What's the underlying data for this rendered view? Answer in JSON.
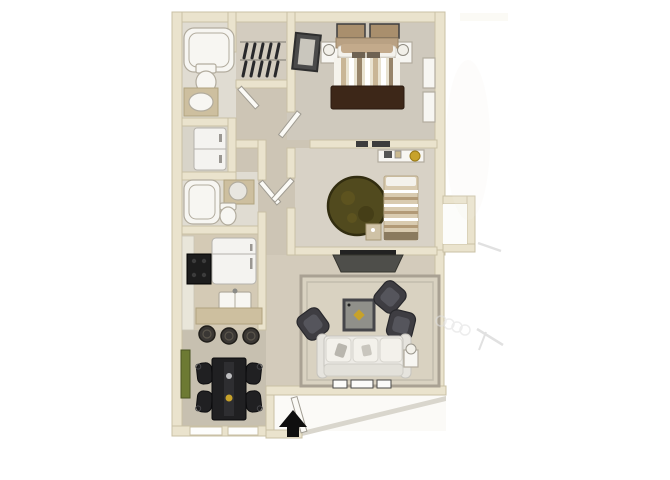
{
  "image": {
    "kind": "3d-rendered-apartment-floor-plan",
    "view": "top-down",
    "entry_marker": "black-up-arrow-at-entrance"
  },
  "palette": {
    "background": "#ffffff",
    "wall": "#eae3cd",
    "wall_edge": "#c9c0a5",
    "floor_hall": "#cdc5b5",
    "floor_master": "#cfc9bd",
    "floor_bedroom2": "#d8d2c6",
    "floor_living": "#d3cbbb",
    "floor_dining": "#c7c0b0",
    "floor_bath": "#e0dcd2",
    "floor_utility": "#d8d4c9",
    "floor_kitchen": "#d4cab5",
    "floor_closet": "#d3ccbf",
    "fixture": "#f7f6f2",
    "fixture_edge": "#b2ac9e",
    "appliance": "#f4f3f0",
    "appliance_edge": "#b5b2ac",
    "counter": "#cdbf9f",
    "counter_edge": "#b1a37f",
    "door": "#fbfaf6",
    "door_edge": "#a09c92",
    "window": "#fdfdfc",
    "rug_living": "#d9d2c1",
    "rug_living_edge": "#a9a193",
    "rug_round": "#514a1e",
    "rug_round_edge": "#322d10",
    "sofa": "#eceae5",
    "sofa_edge": "#c6c4be",
    "armchair": "#3e3d42",
    "armchair_edge": "#28282c",
    "coffee_table": "#90908a",
    "coffee_table_edge": "#46464a",
    "gold_accent": "#c7a22a",
    "tv_console": "#4e4e4a",
    "dining_set": "#202022",
    "stool": "#3a3734",
    "bed_tan": "#c3aa8b",
    "bed_stripe": "#97846a",
    "blanket_brown": "#3d2718",
    "clothes_dark": "#28282b",
    "art_green": "#6d7a33",
    "arrow": "#0f0f0f",
    "faint_mark": "#c9c9c9"
  },
  "floorplan": {
    "rooms": [
      {
        "id": "master-bedroom",
        "furniture": [
          "bed",
          "nightstand-left",
          "nightstand-right",
          "table-lamps",
          "wall-art-frames-2",
          "leaning-mirror",
          "dresser"
        ]
      },
      {
        "id": "walk-in-closet",
        "furniture": [
          "clothes-rod-upper",
          "clothes-rod-lower",
          "hanging-clothes"
        ]
      },
      {
        "id": "bathroom-1",
        "furniture": [
          "bathtub",
          "toilet",
          "vanity-sink"
        ]
      },
      {
        "id": "laundry-closet",
        "furniture": [
          "washer-dryer"
        ]
      },
      {
        "id": "bathroom-2",
        "furniture": [
          "bathtub",
          "toilet",
          "vanity-round-sink"
        ]
      },
      {
        "id": "bedroom-2",
        "furniture": [
          "bed",
          "round-shag-rug",
          "desk",
          "nightstand",
          "wall-vents"
        ]
      },
      {
        "id": "kitchen",
        "furniture": [
          "refrigerator",
          "range",
          "double-sink",
          "breakfast-bar",
          "bar-stools-3"
        ]
      },
      {
        "id": "dining-area",
        "furniture": [
          "dining-table",
          "dining-chairs-4",
          "green-wall-art",
          "windows-2"
        ]
      },
      {
        "id": "living-room",
        "furniture": [
          "sofa",
          "armchairs-3",
          "coffee-table",
          "tv-console",
          "area-rug",
          "side-table-with-lamp",
          "console-frames-3"
        ]
      },
      {
        "id": "entry",
        "furniture": [
          "open-entry-door",
          "direction-arrow"
        ]
      },
      {
        "id": "patio",
        "furniture": [
          "faint-railing-marks"
        ]
      },
      {
        "id": "exterior-storage-closet",
        "furniture": []
      }
    ]
  }
}
